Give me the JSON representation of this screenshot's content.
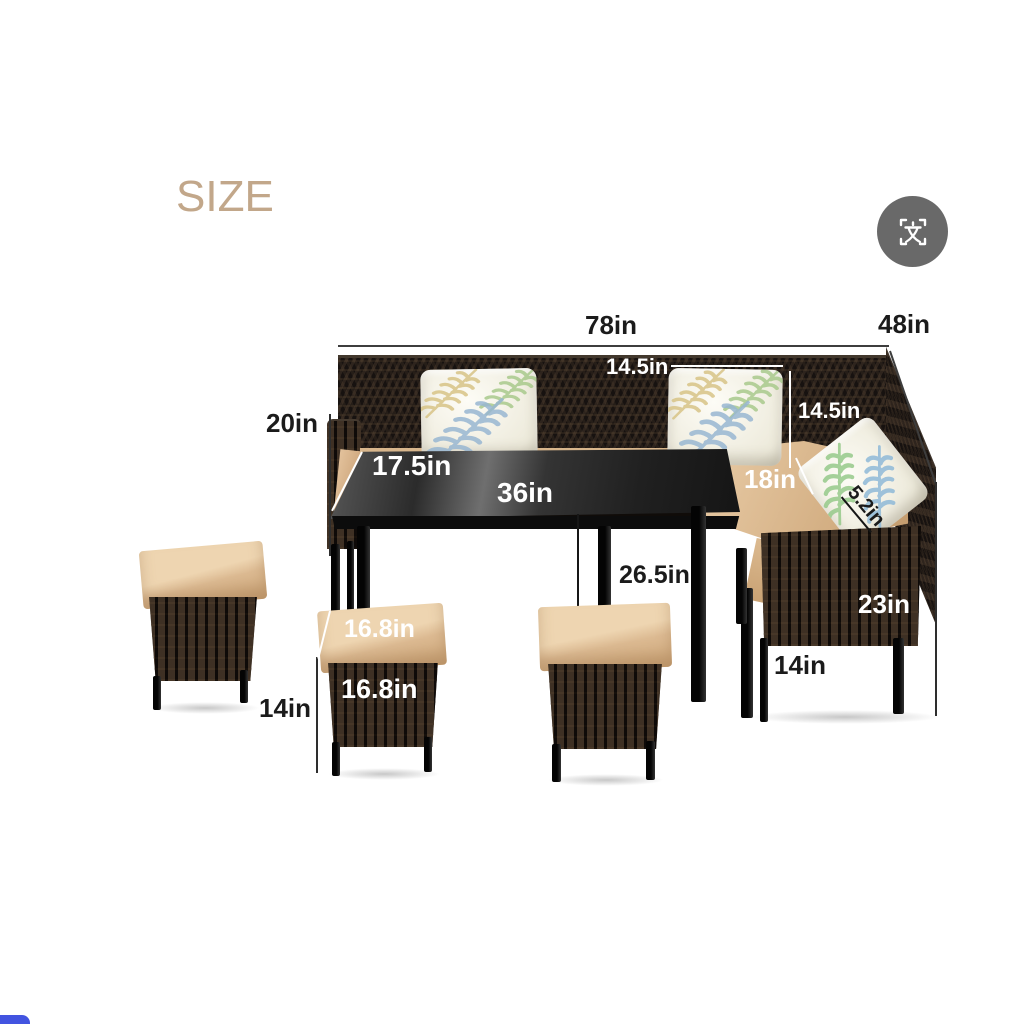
{
  "header": {
    "size_title": "SIZE"
  },
  "toolbar": {
    "button_icon": "translate-icon"
  },
  "dimensions": {
    "overall_width": "78in",
    "overall_depth": "48in",
    "back_section_width": "14.5in",
    "back_height": "14.5in",
    "arm_height": "20in",
    "table_depth": "17.5in",
    "table_length": "36in",
    "seat_depth": "18in",
    "pillow_thickness": "5.2in",
    "table_height": "26.5in",
    "chair_height": "23in",
    "chair_leg_height": "14in",
    "ottoman_leg_height": "14in",
    "ottoman_top_width": "16.8in",
    "ottoman_front_width": "16.8in"
  },
  "colors": {
    "title_tan": "#c2a78a",
    "icon_gray": "#696969",
    "cushion_tan": "#dcba92",
    "rattan_dark": "#171210",
    "accent_blue": "#4254e0",
    "annotation_dark": "#1b1b1b",
    "annotation_light": "#ffffff"
  }
}
